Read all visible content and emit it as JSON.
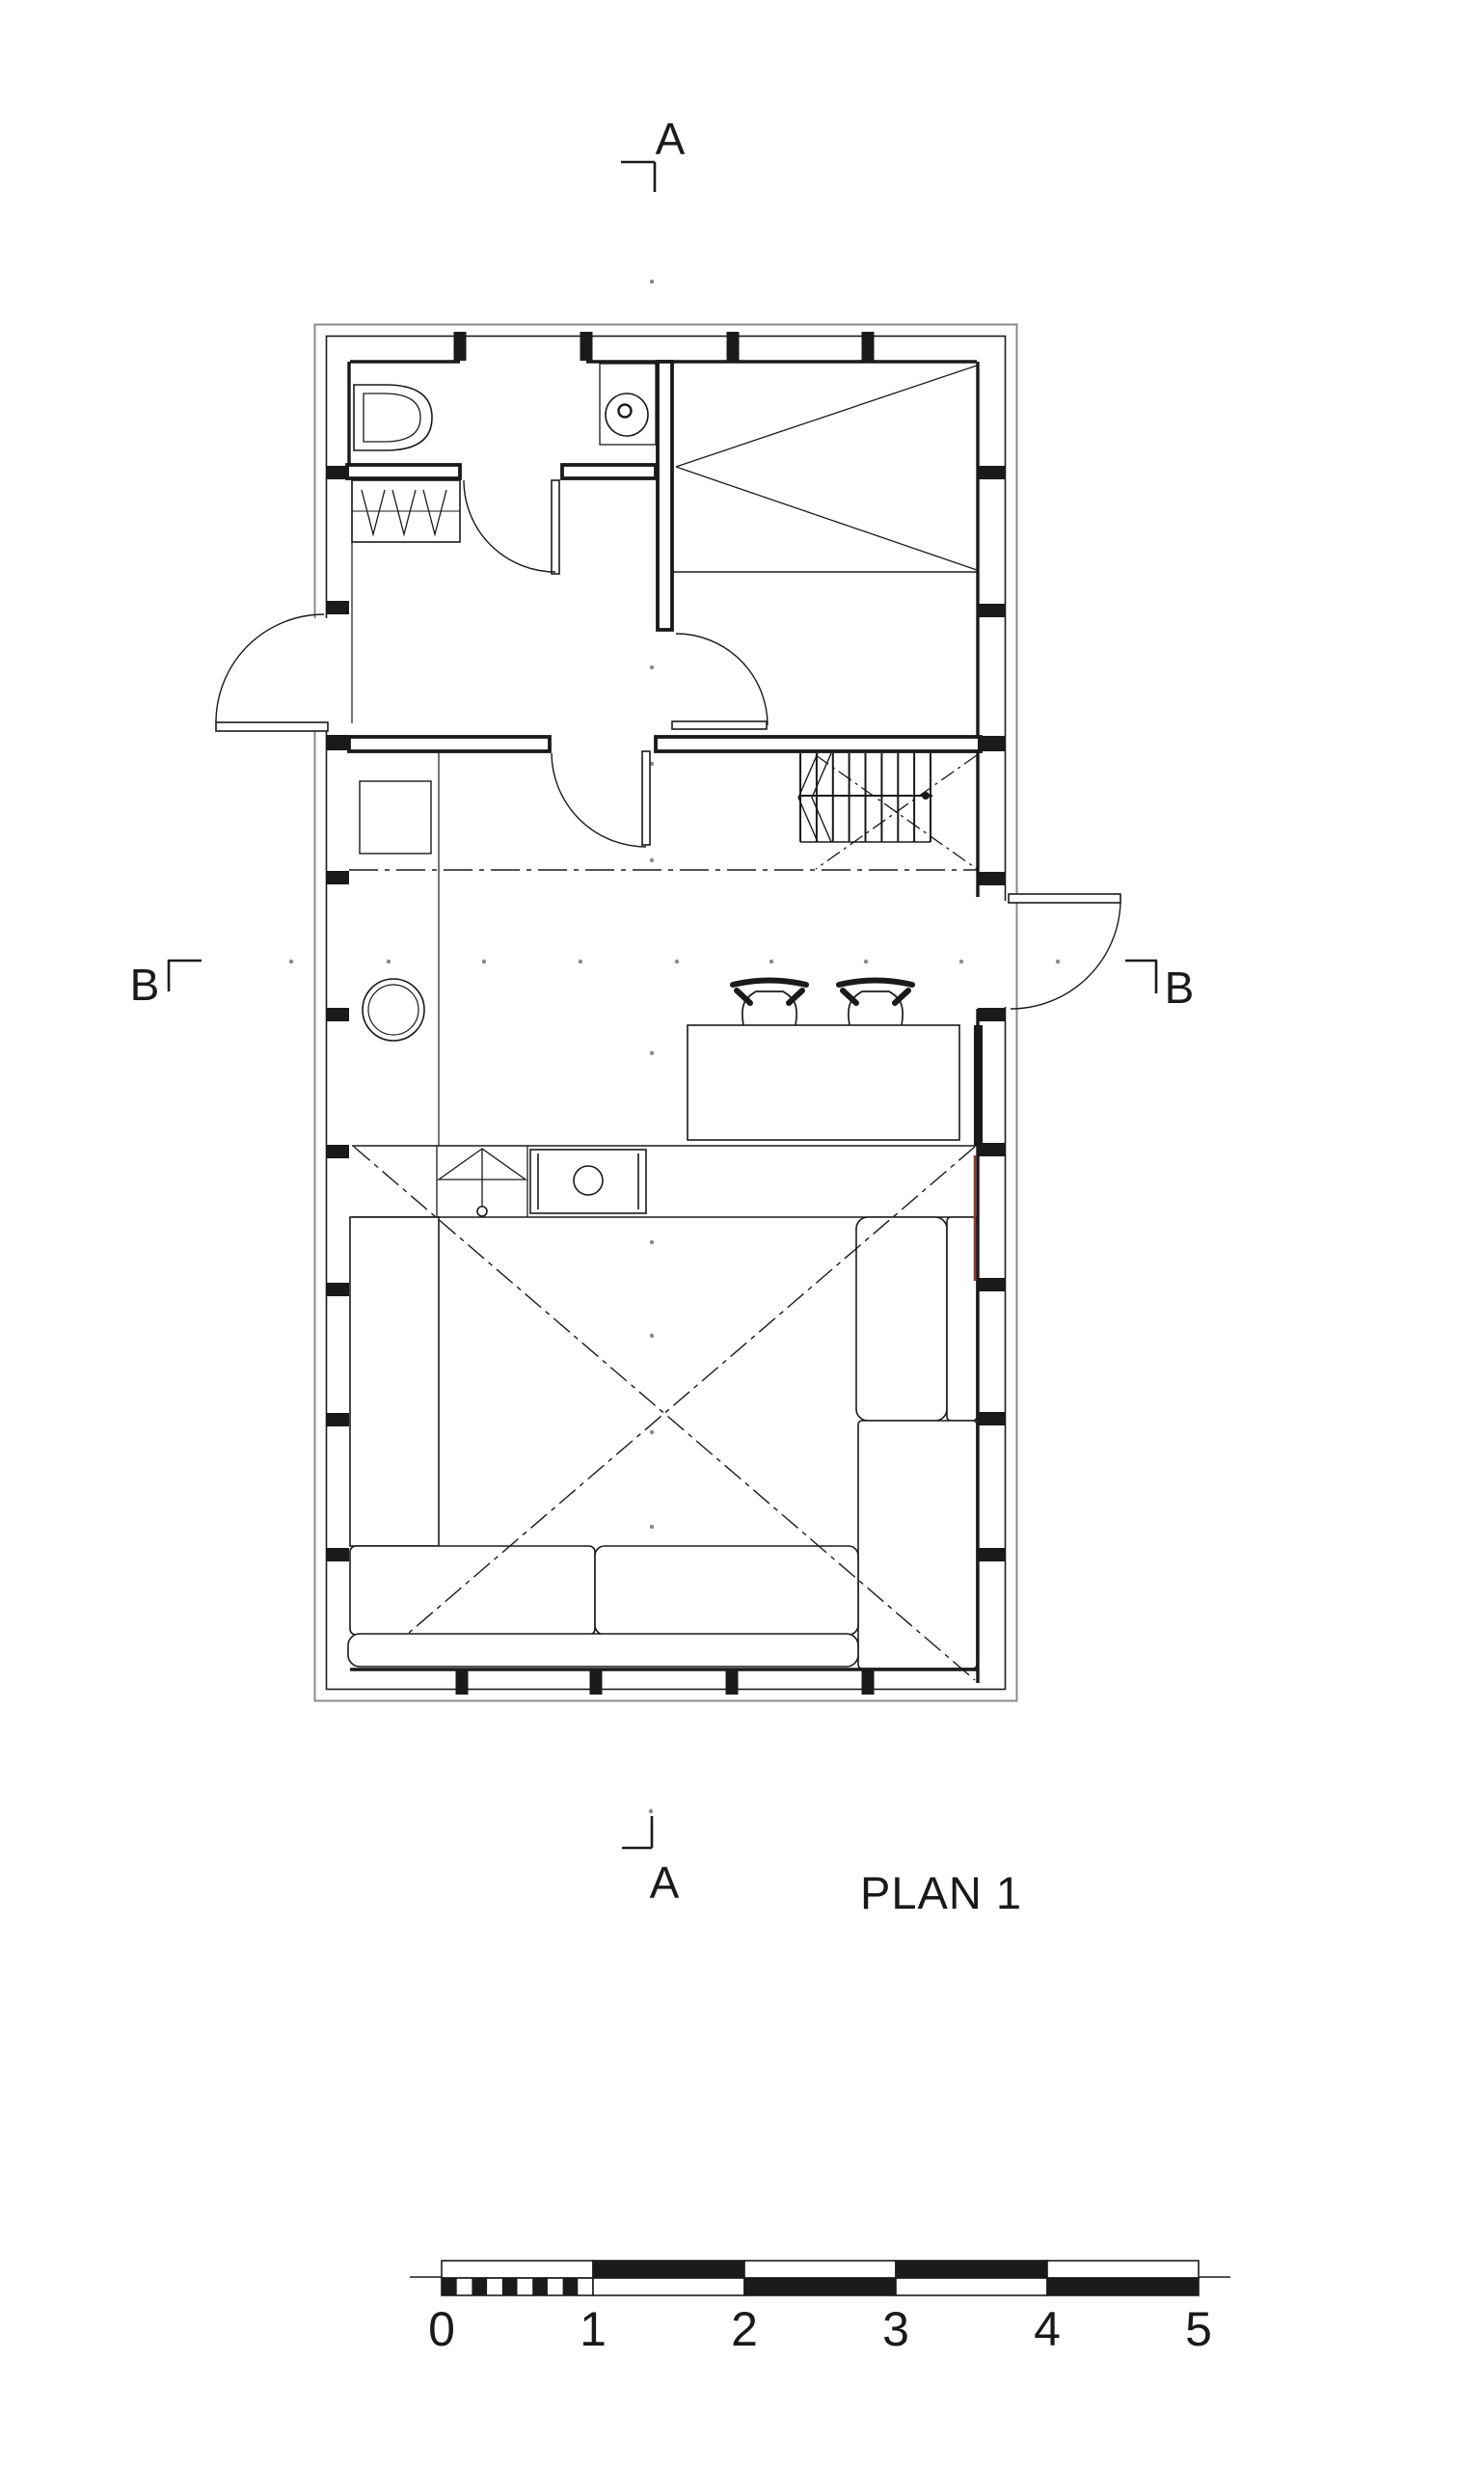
{
  "drawing": {
    "title": "PLAN 1",
    "sections": {
      "a_top": "A",
      "a_bottom": "A",
      "b_left": "B",
      "b_right": "B"
    },
    "scale_bar": {
      "ticks": [
        "0",
        "1",
        "2",
        "3",
        "4",
        "5"
      ]
    },
    "colors": {
      "ink": "#1a1a1a",
      "muted": "#8a8a8a",
      "accent": "#8e3b2f",
      "paper": "#ffffff"
    },
    "symbols": [
      "toilet",
      "wash-basin",
      "wardrobe",
      "double-bed",
      "staircase",
      "dining-table",
      "bar-stool",
      "round-table",
      "kitchen-counter",
      "sink-unit",
      "cooktop",
      "cabinet",
      "sofa",
      "armchair",
      "chaise",
      "hinged-door",
      "section-line"
    ]
  }
}
